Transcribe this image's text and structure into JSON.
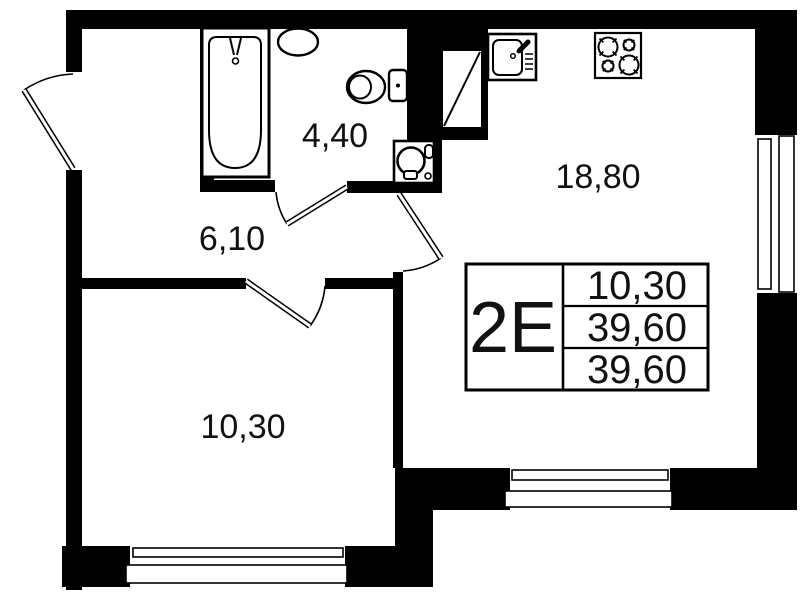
{
  "rooms": {
    "bathroom": {
      "area": "4,40"
    },
    "hallway": {
      "area": "6,10"
    },
    "kitchen_living": {
      "area": "18,80"
    },
    "bedroom": {
      "area": "10,30"
    }
  },
  "info_table": {
    "type_label": "2Е",
    "rows": [
      "10,30",
      "39,60",
      "39,60"
    ]
  },
  "fixtures": [
    "bathtub",
    "washbasin",
    "toilet",
    "washing-machine",
    "ventilation-shaft",
    "kitchen-sink",
    "stove-4-burner"
  ],
  "colors": {
    "ink": "#000000",
    "paper": "#ffffff",
    "text": "#111111"
  }
}
